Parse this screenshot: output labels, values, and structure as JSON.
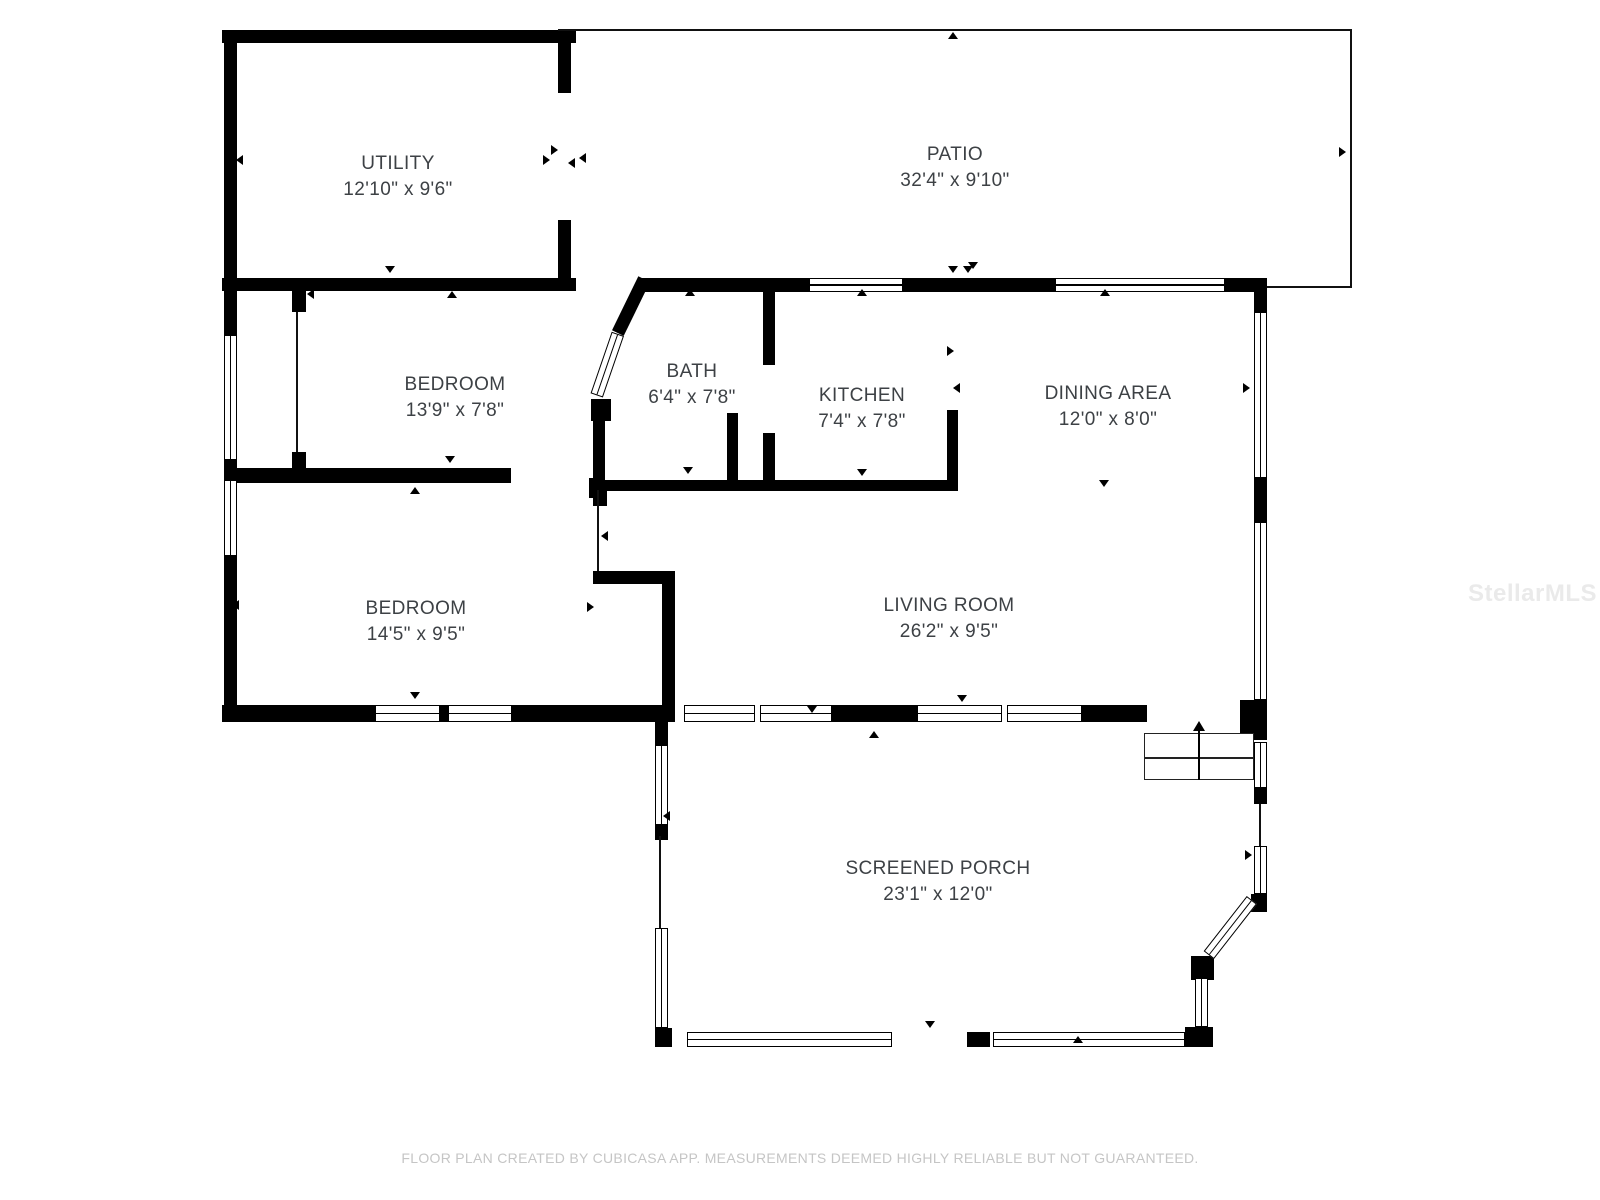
{
  "plan": {
    "footer": "FLOOR PLAN CREATED BY CUBICASA APP. MEASUREMENTS DEEMED HIGHLY RELIABLE BUT NOT GUARANTEED.",
    "watermark": "StellarMLS",
    "wall_color": "#000000",
    "label_color": "#3d4145",
    "footer_color": "#c5c5c5",
    "rooms": [
      {
        "id": "utility",
        "name": "UTILITY",
        "dims": "12'10\" x 9'6\"",
        "cx": 398,
        "cy": 177
      },
      {
        "id": "patio",
        "name": "PATIO",
        "dims": "32'4\" x 9'10\"",
        "cx": 955,
        "cy": 168
      },
      {
        "id": "bedroom-1",
        "name": "BEDROOM",
        "dims": "13'9\" x 7'8\"",
        "cx": 455,
        "cy": 398
      },
      {
        "id": "bath",
        "name": "BATH",
        "dims": "6'4\" x 7'8\"",
        "cx": 692,
        "cy": 385
      },
      {
        "id": "kitchen",
        "name": "KITCHEN",
        "dims": "7'4\" x 7'8\"",
        "cx": 862,
        "cy": 409
      },
      {
        "id": "dining-area",
        "name": "DINING AREA",
        "dims": "12'0\" x 8'0\"",
        "cx": 1108,
        "cy": 407
      },
      {
        "id": "bedroom-2",
        "name": "BEDROOM",
        "dims": "14'5\" x 9'5\"",
        "cx": 416,
        "cy": 622
      },
      {
        "id": "living-room",
        "name": "LIVING ROOM",
        "dims": "26'2\" x 9'5\"",
        "cx": 949,
        "cy": 619
      },
      {
        "id": "screened-porch",
        "name": "SCREENED PORCH",
        "dims": "23'1\" x 12'0\"",
        "cx": 938,
        "cy": 882
      }
    ],
    "geometry": {
      "walls": [
        [
          222,
          30,
          354,
          13
        ],
        [
          224,
          30,
          13,
          261
        ],
        [
          222,
          278,
          354,
          13
        ],
        [
          558,
          30,
          13,
          63
        ],
        [
          558,
          220,
          13,
          71
        ],
        [
          640,
          278,
          169,
          14
        ],
        [
          903,
          278,
          152,
          14
        ],
        [
          1225,
          278,
          42,
          14
        ],
        [
          1254,
          292,
          13,
          20
        ],
        [
          1254,
          478,
          13,
          44
        ],
        [
          1240,
          700,
          27,
          40
        ],
        [
          224,
          291,
          13,
          44
        ],
        [
          224,
          460,
          13,
          20
        ],
        [
          224,
          556,
          13,
          166
        ],
        [
          222,
          705,
          153,
          17
        ],
        [
          440,
          705,
          8,
          17
        ],
        [
          512,
          705,
          160,
          17
        ],
        [
          832,
          705,
          85,
          17
        ],
        [
          1082,
          705,
          65,
          17
        ],
        [
          292,
          291,
          14,
          21
        ],
        [
          292,
          452,
          14,
          20
        ],
        [
          225,
          468,
          286,
          15
        ],
        [
          589,
          478,
          16,
          20
        ],
        [
          593,
          480,
          365,
          11
        ],
        [
          593,
          418,
          12,
          66
        ],
        [
          591,
          399,
          20,
          22
        ],
        [
          727,
          413,
          11,
          70
        ],
        [
          947,
          410,
          11,
          73
        ],
        [
          763,
          288,
          12,
          77
        ],
        [
          763,
          433,
          12,
          50
        ],
        [
          593,
          571,
          82,
          13
        ],
        [
          662,
          584,
          13,
          138
        ],
        [
          593,
          488,
          14,
          18
        ],
        [
          655,
          705,
          13,
          40
        ],
        [
          655,
          825,
          13,
          15
        ],
        [
          655,
          1028,
          17,
          19
        ],
        [
          967,
          1032,
          23,
          15
        ],
        [
          1185,
          1027,
          28,
          20
        ],
        [
          1191,
          956,
          23,
          24
        ],
        [
          1251,
          894,
          16,
          18
        ],
        [
          1254,
          788,
          13,
          16
        ]
      ],
      "thin_walls": [
        [
          558,
          29,
          794,
          2
        ],
        [
          1350,
          29,
          2,
          259
        ],
        [
          1267,
          286,
          85,
          2
        ],
        [
          296,
          312,
          2,
          140
        ],
        [
          597,
          490,
          2,
          81
        ],
        [
          659,
          836,
          2,
          94
        ],
        [
          1259,
          804,
          2,
          42
        ]
      ],
      "windows": [
        [
          809,
          278,
          94,
          14,
          "h",
          0
        ],
        [
          1055,
          278,
          170,
          14,
          "h",
          0
        ],
        [
          375,
          705,
          65,
          17,
          "h",
          0
        ],
        [
          448,
          705,
          64,
          17,
          "h",
          0
        ],
        [
          684,
          705,
          148,
          17,
          "h",
          756
        ],
        [
          917,
          705,
          165,
          17,
          "h",
          1003
        ],
        [
          687,
          1032,
          205,
          15,
          "h",
          0
        ],
        [
          993,
          1032,
          192,
          15,
          "h",
          0
        ],
        [
          224,
          335,
          13,
          125,
          "v",
          0
        ],
        [
          224,
          480,
          13,
          76,
          "v",
          0
        ],
        [
          1254,
          312,
          13,
          166,
          "v",
          0
        ],
        [
          1254,
          522,
          13,
          178,
          "v",
          0
        ],
        [
          655,
          745,
          13,
          80,
          "v",
          0
        ],
        [
          655,
          928,
          13,
          100,
          "v",
          0
        ],
        [
          1254,
          742,
          13,
          46,
          "v",
          0
        ],
        [
          1254,
          846,
          13,
          48,
          "v",
          0
        ],
        [
          1195,
          978,
          13,
          49,
          "v",
          0
        ]
      ],
      "diagonals": [
        {
          "x": 650,
          "y": 282,
          "len": 60,
          "angle": 116,
          "kind": "wallk"
        },
        {
          "x": 624,
          "y": 336,
          "len": 65,
          "angle": 109,
          "kind": "wink"
        },
        {
          "x": 1257,
          "y": 904,
          "len": 70,
          "angle": 128,
          "kind": "wink"
        }
      ],
      "markers": [
        [
          396,
          38,
          "up"
        ],
        [
          390,
          271,
          "down"
        ],
        [
          241,
          160,
          "left"
        ],
        [
          548,
          160,
          "right"
        ],
        [
          556,
          150,
          "right"
        ],
        [
          573,
          163,
          "left"
        ],
        [
          953,
          37,
          "up"
        ],
        [
          953,
          271,
          "down"
        ],
        [
          1344,
          152,
          "right"
        ],
        [
          584,
          158,
          "left"
        ],
        [
          452,
          296,
          "up"
        ],
        [
          450,
          461,
          "down"
        ],
        [
          312,
          294,
          "left"
        ],
        [
          690,
          294,
          "up"
        ],
        [
          688,
          472,
          "down"
        ],
        [
          862,
          294,
          "up"
        ],
        [
          968,
          271,
          "down"
        ],
        [
          862,
          474,
          "down"
        ],
        [
          952,
          351,
          "right"
        ],
        [
          958,
          388,
          "left"
        ],
        [
          973,
          267,
          "down"
        ],
        [
          1105,
          294,
          "up"
        ],
        [
          1104,
          485,
          "down"
        ],
        [
          1248,
          388,
          "right"
        ],
        [
          450,
          477,
          "down"
        ],
        [
          415,
          492,
          "up"
        ],
        [
          237,
          605,
          "left"
        ],
        [
          592,
          607,
          "right"
        ],
        [
          415,
          697,
          "down"
        ],
        [
          606,
          536,
          "left"
        ],
        [
          962,
          700,
          "down"
        ],
        [
          812,
          711,
          "down"
        ],
        [
          874,
          736,
          "up"
        ],
        [
          668,
          816,
          "left"
        ],
        [
          1250,
          855,
          "right"
        ],
        [
          930,
          1026,
          "down"
        ],
        [
          1078,
          1041,
          "up"
        ]
      ],
      "stairs": {
        "x": 1144,
        "y": 733,
        "w": 110,
        "h": 47,
        "mid": 757,
        "arrow_x": 1198
      }
    }
  }
}
